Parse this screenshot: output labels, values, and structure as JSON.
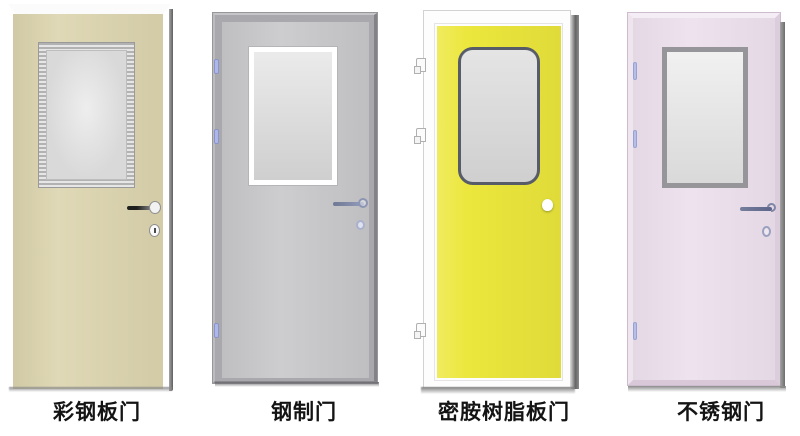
{
  "page": {
    "background": "#ffffff"
  },
  "doors": [
    {
      "label": "彩钢板门",
      "leaf_color": "#dcd4ae",
      "glass_color": "#d9d9d9",
      "window_frame": "silver-metallic",
      "hardware": "lever-handle-and-keyhole"
    },
    {
      "label": "钢制门",
      "leaf_color": "#c9c9cc",
      "frame_color": "#a9a9ad",
      "glass_color": "#dadada",
      "window_frame": "white",
      "hardware": "lever-handle-and-keyhole"
    },
    {
      "label": "密胺树脂板门",
      "leaf_color": "#ece73c",
      "frame_color": "#fdfdfd",
      "glass_color": "#d6d6d6",
      "window_frame": "dark-rounded",
      "hardware": "knob"
    },
    {
      "label": "不锈钢门",
      "leaf_color": "#ecdfec",
      "glass_color": "#e2e2e2",
      "window_frame": "gray",
      "hardware": "lever-handle-and-keyhole"
    }
  ]
}
